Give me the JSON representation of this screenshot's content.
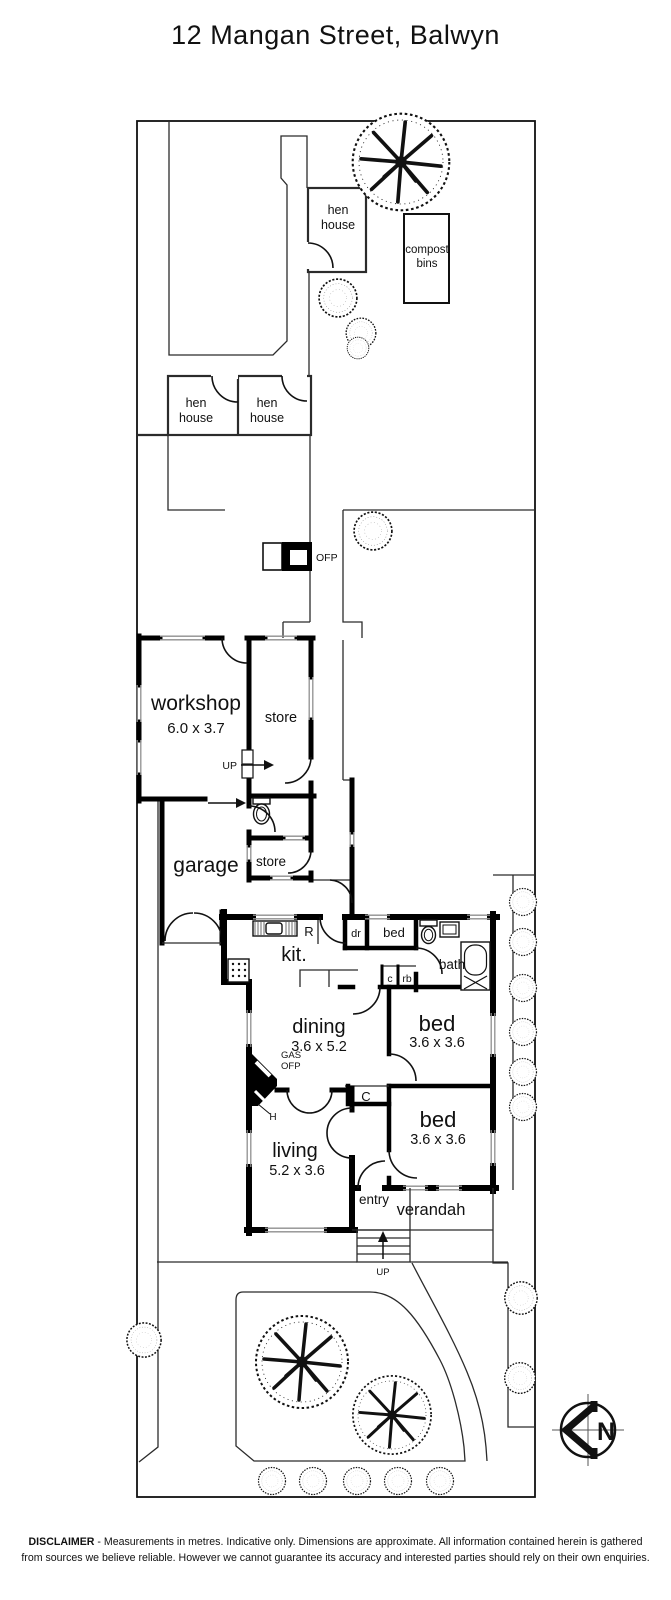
{
  "title": "12 Mangan Street, Balwyn",
  "site": {
    "hen_house_top": {
      "l1": "hen",
      "l2": "house"
    },
    "compost_bins": {
      "l1": "compost",
      "l2": "bins"
    },
    "hen_house_left": {
      "l1": "hen",
      "l2": "house"
    },
    "hen_house_right": {
      "l1": "hen",
      "l2": "house"
    },
    "ofp": "OFP",
    "workshop": {
      "name": "workshop",
      "dims": "6.0 x 3.7"
    },
    "store_upper": "store",
    "store_lower": "store",
    "up_workshop": "UP",
    "garage": "garage",
    "up_steps": "UP"
  },
  "house": {
    "kitchen": "kit.",
    "fridge": "R",
    "drawers": "dr",
    "bed_nook": "bed",
    "bath": "bath",
    "cupboard_small": "c",
    "robe": "rb",
    "dining": {
      "name": "dining",
      "dims": "3.6 x 5.2"
    },
    "bed_one": {
      "name": "bed",
      "dims": "3.6 x 3.6"
    },
    "bed_two": {
      "name": "bed",
      "dims": "3.6 x 3.6"
    },
    "living": {
      "name": "living",
      "dims": "5.2 x 3.6"
    },
    "gas_ofp": {
      "l1": "GAS",
      "l2": "OFP"
    },
    "hearth": "H",
    "hall_cupboard": "C",
    "entry": "entry",
    "verandah": "verandah"
  },
  "compass": {
    "north": "N"
  },
  "disclaimer": {
    "bold": "DISCLAIMER",
    "line1": " - Measurements in metres. Indicative only. Dimensions are approximate. All information contained herein is gathered",
    "line2": "from sources we believe reliable. However we cannot guarantee its accuracy and interested parties should rely on their own enquiries."
  },
  "colors": {
    "ink": "#111111",
    "wall": "#000000",
    "window": "#8f8f8f",
    "background": "#ffffff"
  }
}
